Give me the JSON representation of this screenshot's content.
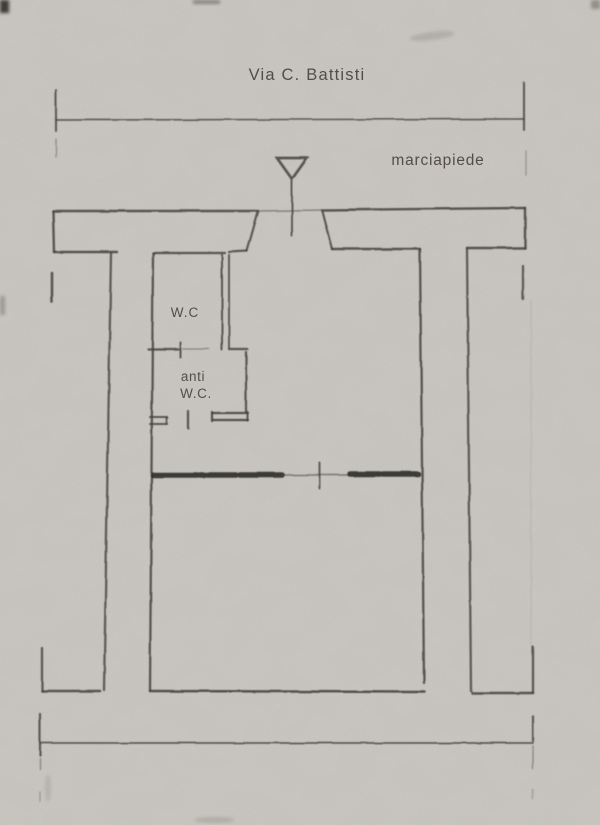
{
  "colors": {
    "paper": "#cbc8c2",
    "ink": "#45423d",
    "ink_dark": "#2f2d29",
    "label_text": "#524e48"
  },
  "plan": {
    "street_label": "Via C. Battisti",
    "sidewalk_label": "marciapiede",
    "wc_label": "W.C",
    "anti_wc_label_line1": "anti",
    "anti_wc_label_line2": "W.C."
  }
}
